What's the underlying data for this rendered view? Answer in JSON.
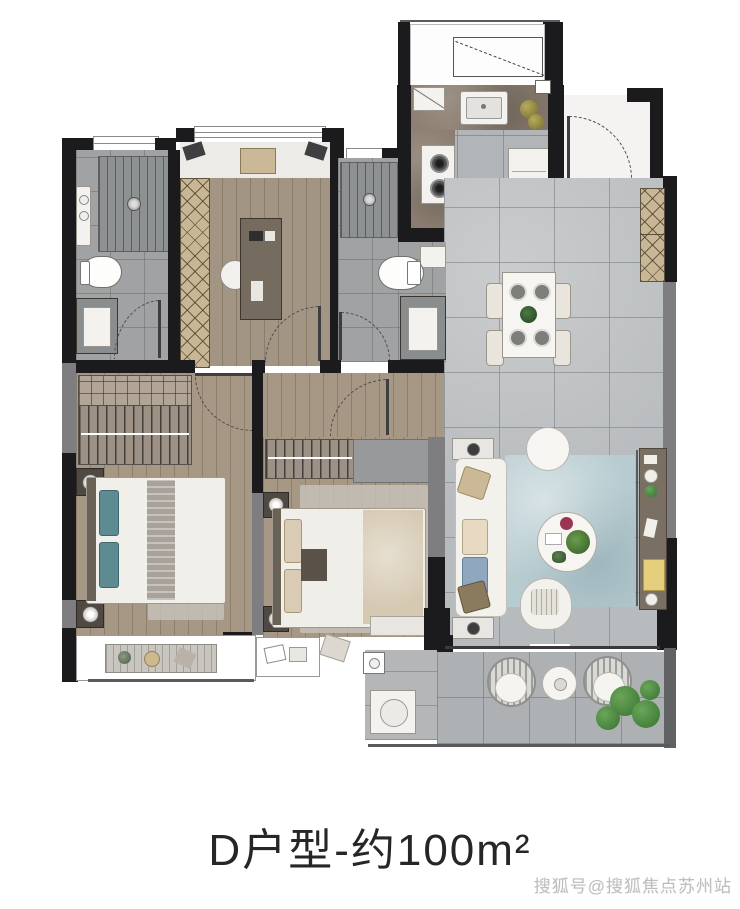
{
  "title": {
    "text": "D户型-约100m²"
  },
  "watermark": {
    "text": "搜狐号@搜狐焦点苏州站"
  },
  "colors": {
    "wall": "#1b1b1d",
    "wall_concrete": "#7e7e80",
    "tile_floor": "#b8bbbd",
    "wood_floor": "#a69885",
    "bath_floor": "#a0a2a3",
    "counter_brown": "#8a7d6f",
    "cabinet_wood": "#c8b694",
    "rug_teal": "#b7ccd1",
    "accent_teal": "#5d8b92",
    "beige": "#d9cbb4",
    "book_yellow": "#e6cf7c",
    "plant_green": "#47823d",
    "furniture_white": "#f4f2ee"
  },
  "floorplan": {
    "rooms": [
      {
        "name": "utility-platform",
        "icons": [
          "drying-rack-icon"
        ]
      },
      {
        "name": "kitchen",
        "icons": [
          "sink-icon",
          "stove-icon",
          "fridge-icon",
          "counter-icon",
          "vegetable-basket-icon"
        ]
      },
      {
        "name": "entry",
        "icons": [
          "entry-door-icon"
        ]
      },
      {
        "name": "dining-area",
        "icons": [
          "dining-table-icon",
          "chair-icon",
          "plate-icon",
          "centerpiece-icon",
          "shoe-cabinet-icon"
        ]
      },
      {
        "name": "living-room",
        "icons": [
          "sofa-icon",
          "coffee-table-icon",
          "side-table-icon",
          "armchair-icon",
          "rug-icon",
          "tv-console-icon",
          "books-icon"
        ]
      },
      {
        "name": "master-bathroom",
        "icons": [
          "shower-icon",
          "toilet-icon",
          "vanity-icon",
          "washbasin-icon"
        ]
      },
      {
        "name": "bathroom-2",
        "icons": [
          "shower-icon",
          "toilet-icon",
          "vanity-icon"
        ]
      },
      {
        "name": "study",
        "icons": [
          "desk-icon",
          "desk-chair-icon",
          "wardrobe-icon",
          "doormat-icon",
          "wall-lamp-icon"
        ]
      },
      {
        "name": "master-bedroom",
        "icons": [
          "double-bed-icon",
          "wardrobe-hangers-icon",
          "nightstand-icon",
          "lamp-icon",
          "bay-window-icon"
        ]
      },
      {
        "name": "bedroom-2",
        "icons": [
          "double-bed-icon",
          "wardrobe-hangers-icon",
          "nightstand-icon",
          "desk-icon",
          "bay-window-icon"
        ]
      },
      {
        "name": "balcony",
        "icons": [
          "rattan-chair-icon",
          "round-table-icon",
          "plants-icon",
          "laundry-sink-icon"
        ]
      }
    ]
  }
}
